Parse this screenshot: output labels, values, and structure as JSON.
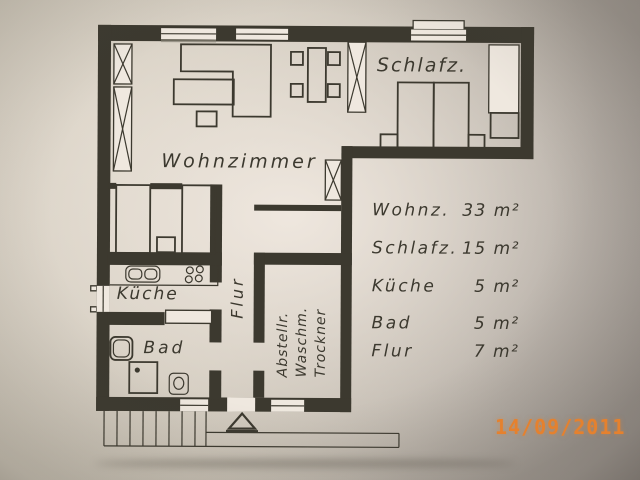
{
  "photo": {
    "date_stamp": "14/09/2011",
    "stamp_color": "#e5812e",
    "background_color": "#b3aca2"
  },
  "plan": {
    "ink_color": "#3c392f",
    "paper_color": "#efe8df",
    "rooms": {
      "wohnzimmer": "Wohnzimmer",
      "schlafzimmer": "Schlafz.",
      "kueche": "Küche",
      "bad": "Bad",
      "flur": "Flur",
      "abstellraum": [
        "Abstellr.",
        "Waschm.",
        "Trockner"
      ]
    }
  },
  "legend": {
    "rows": [
      {
        "label": "Wohnz.",
        "value": "33 m²"
      },
      {
        "label": "Schlafz.",
        "value": "15 m²"
      },
      {
        "label": "Küche",
        "value": "5 m²"
      },
      {
        "label": "Bad",
        "value": "5 m²"
      },
      {
        "label": "Flur",
        "value": "7 m²"
      }
    ]
  }
}
